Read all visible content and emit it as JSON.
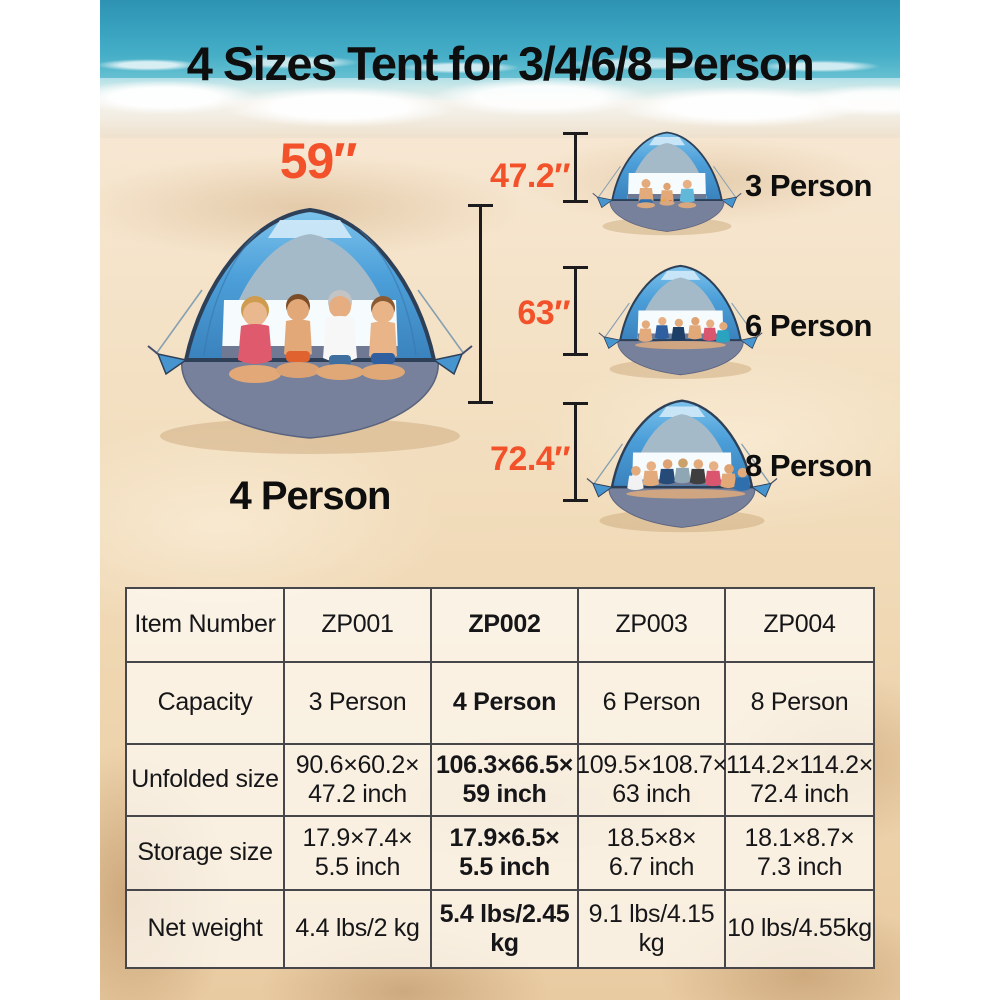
{
  "title": "4 Sizes Tent for 3/4/6/8 Person",
  "colors": {
    "accent_orange": "#f2512a",
    "tent_blue": "#4c9fd9",
    "label_black": "#0e0e0e"
  },
  "hero": {
    "width_label": "59″",
    "capacity_label": "4 Person"
  },
  "variants": [
    {
      "height_label": "47.2″",
      "capacity_label": "3 Person"
    },
    {
      "height_label": "63″",
      "capacity_label": "6 Person"
    },
    {
      "height_label": "72.4″",
      "capacity_label": "8 Person"
    }
  ],
  "spec_table": {
    "rows": [
      {
        "label": "Item Number",
        "cells": [
          [
            "ZP001"
          ],
          [
            "ZP002"
          ],
          [
            "ZP003"
          ],
          [
            "ZP004"
          ]
        ]
      },
      {
        "label": "Capacity",
        "cells": [
          [
            "3 Person"
          ],
          [
            "4 Person"
          ],
          [
            "6 Person"
          ],
          [
            "8 Person"
          ]
        ]
      },
      {
        "label": "Unfolded size",
        "cells": [
          [
            "90.6×60.2×",
            "47.2 inch"
          ],
          [
            "106.3×66.5×",
            "59 inch"
          ],
          [
            "109.5×108.7×",
            "63 inch"
          ],
          [
            "114.2×114.2×",
            "72.4 inch"
          ]
        ]
      },
      {
        "label": "Storage size",
        "cells": [
          [
            "17.9×7.4×",
            "5.5 inch"
          ],
          [
            "17.9×6.5×",
            "5.5 inch"
          ],
          [
            "18.5×8×",
            "6.7 inch"
          ],
          [
            "18.1×8.7×",
            "7.3 inch"
          ]
        ]
      },
      {
        "label": "Net weight",
        "cells": [
          [
            "4.4 lbs/2 kg"
          ],
          [
            "5.4 lbs/2.45 kg"
          ],
          [
            "9.1 lbs/4.15 kg"
          ],
          [
            "10 lbs/4.55kg"
          ]
        ]
      }
    ],
    "highlighted_item": "ZP002"
  }
}
